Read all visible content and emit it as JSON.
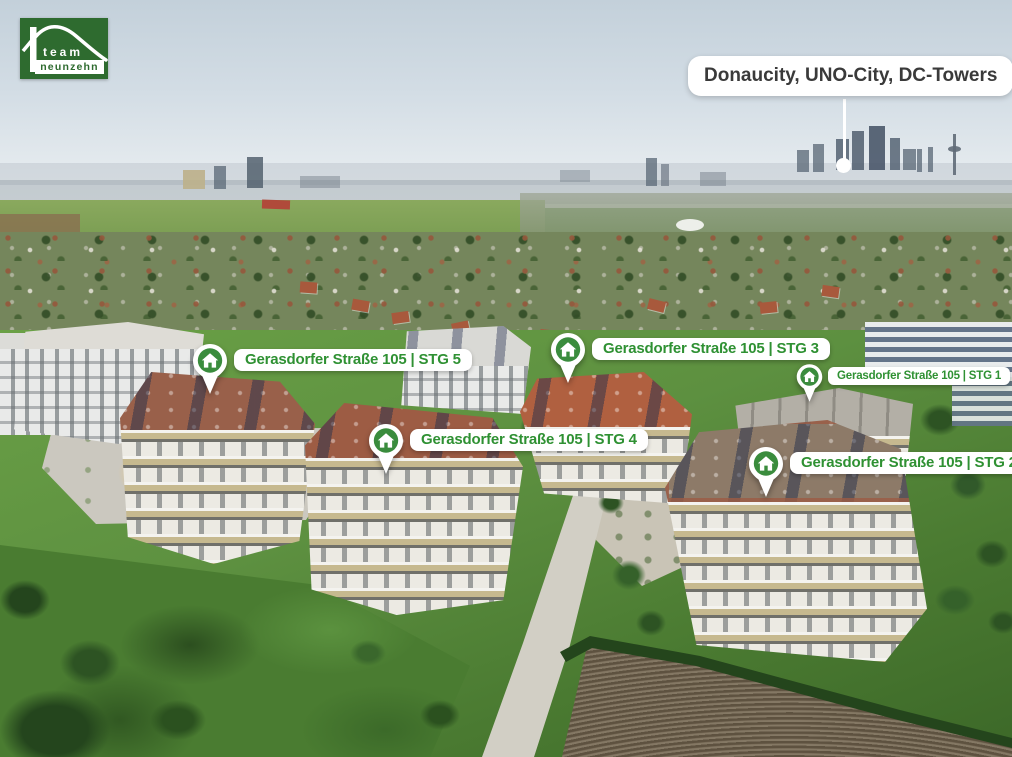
{
  "logo": {
    "line1": "team",
    "line2": "neunzehn"
  },
  "callout": {
    "label": "Donaucity, UNO-City, DC-Towers"
  },
  "markers": [
    {
      "id": "stg5",
      "label": "Gerasdorfer Straße 105 | STG 5"
    },
    {
      "id": "stg3",
      "label": "Gerasdorfer Straße 105 | STG 3"
    },
    {
      "id": "stg1",
      "label": "Gerasdorfer Straße 105 | STG 1"
    },
    {
      "id": "stg4",
      "label": "Gerasdorfer Straße 105 | STG 4"
    },
    {
      "id": "stg2",
      "label": "Gerasdorfer Straße 105 | STG 2"
    }
  ],
  "icons": {
    "marker_pin": "house-pin-icon"
  },
  "colors": {
    "brand_green": "#2e6b2f",
    "marker_green": "#3a8c3d",
    "label_text_green": "#2f9133",
    "callout_text": "#3a3a3a"
  }
}
